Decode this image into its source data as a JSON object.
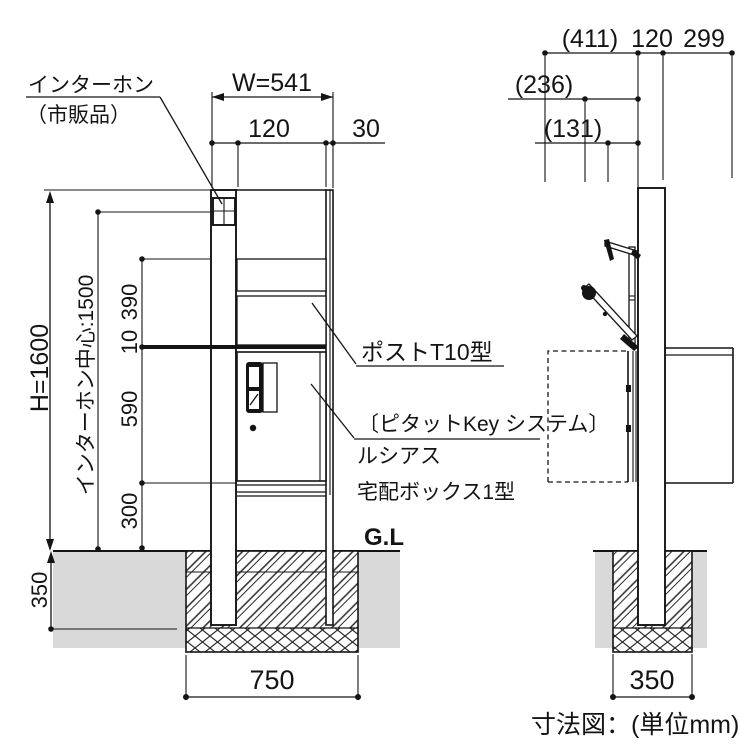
{
  "caption": "寸法図：(単位mm)",
  "colors": {
    "line": "#141414",
    "ground": "#d9d9d9"
  },
  "front_view": {
    "intercom_label": {
      "line1": "インターホン",
      "line2": "（市販品）"
    },
    "gl_label": "G.L",
    "dims": {
      "total_width": "W=541",
      "post_width": "120",
      "side_margin": "30",
      "total_height": "H=1600",
      "intercom_center_height": "インターホン中心:1500",
      "seg_390": "390",
      "seg_10": "10",
      "seg_590": "590",
      "seg_300": "300",
      "embed_depth": "350",
      "foundation_width": "750"
    },
    "callouts": {
      "post": "ポストT10型",
      "key_system": "〔ピタットKey システム〕",
      "series": "ルシアス",
      "product": "宅配ボックス1型"
    }
  },
  "side_view": {
    "dims": {
      "open_door_depth": "(411)",
      "lid_open_depth": "(236)",
      "arm_depth": "(131)",
      "post_depth": "120",
      "box_depth": "299",
      "foundation_width": "350"
    }
  }
}
